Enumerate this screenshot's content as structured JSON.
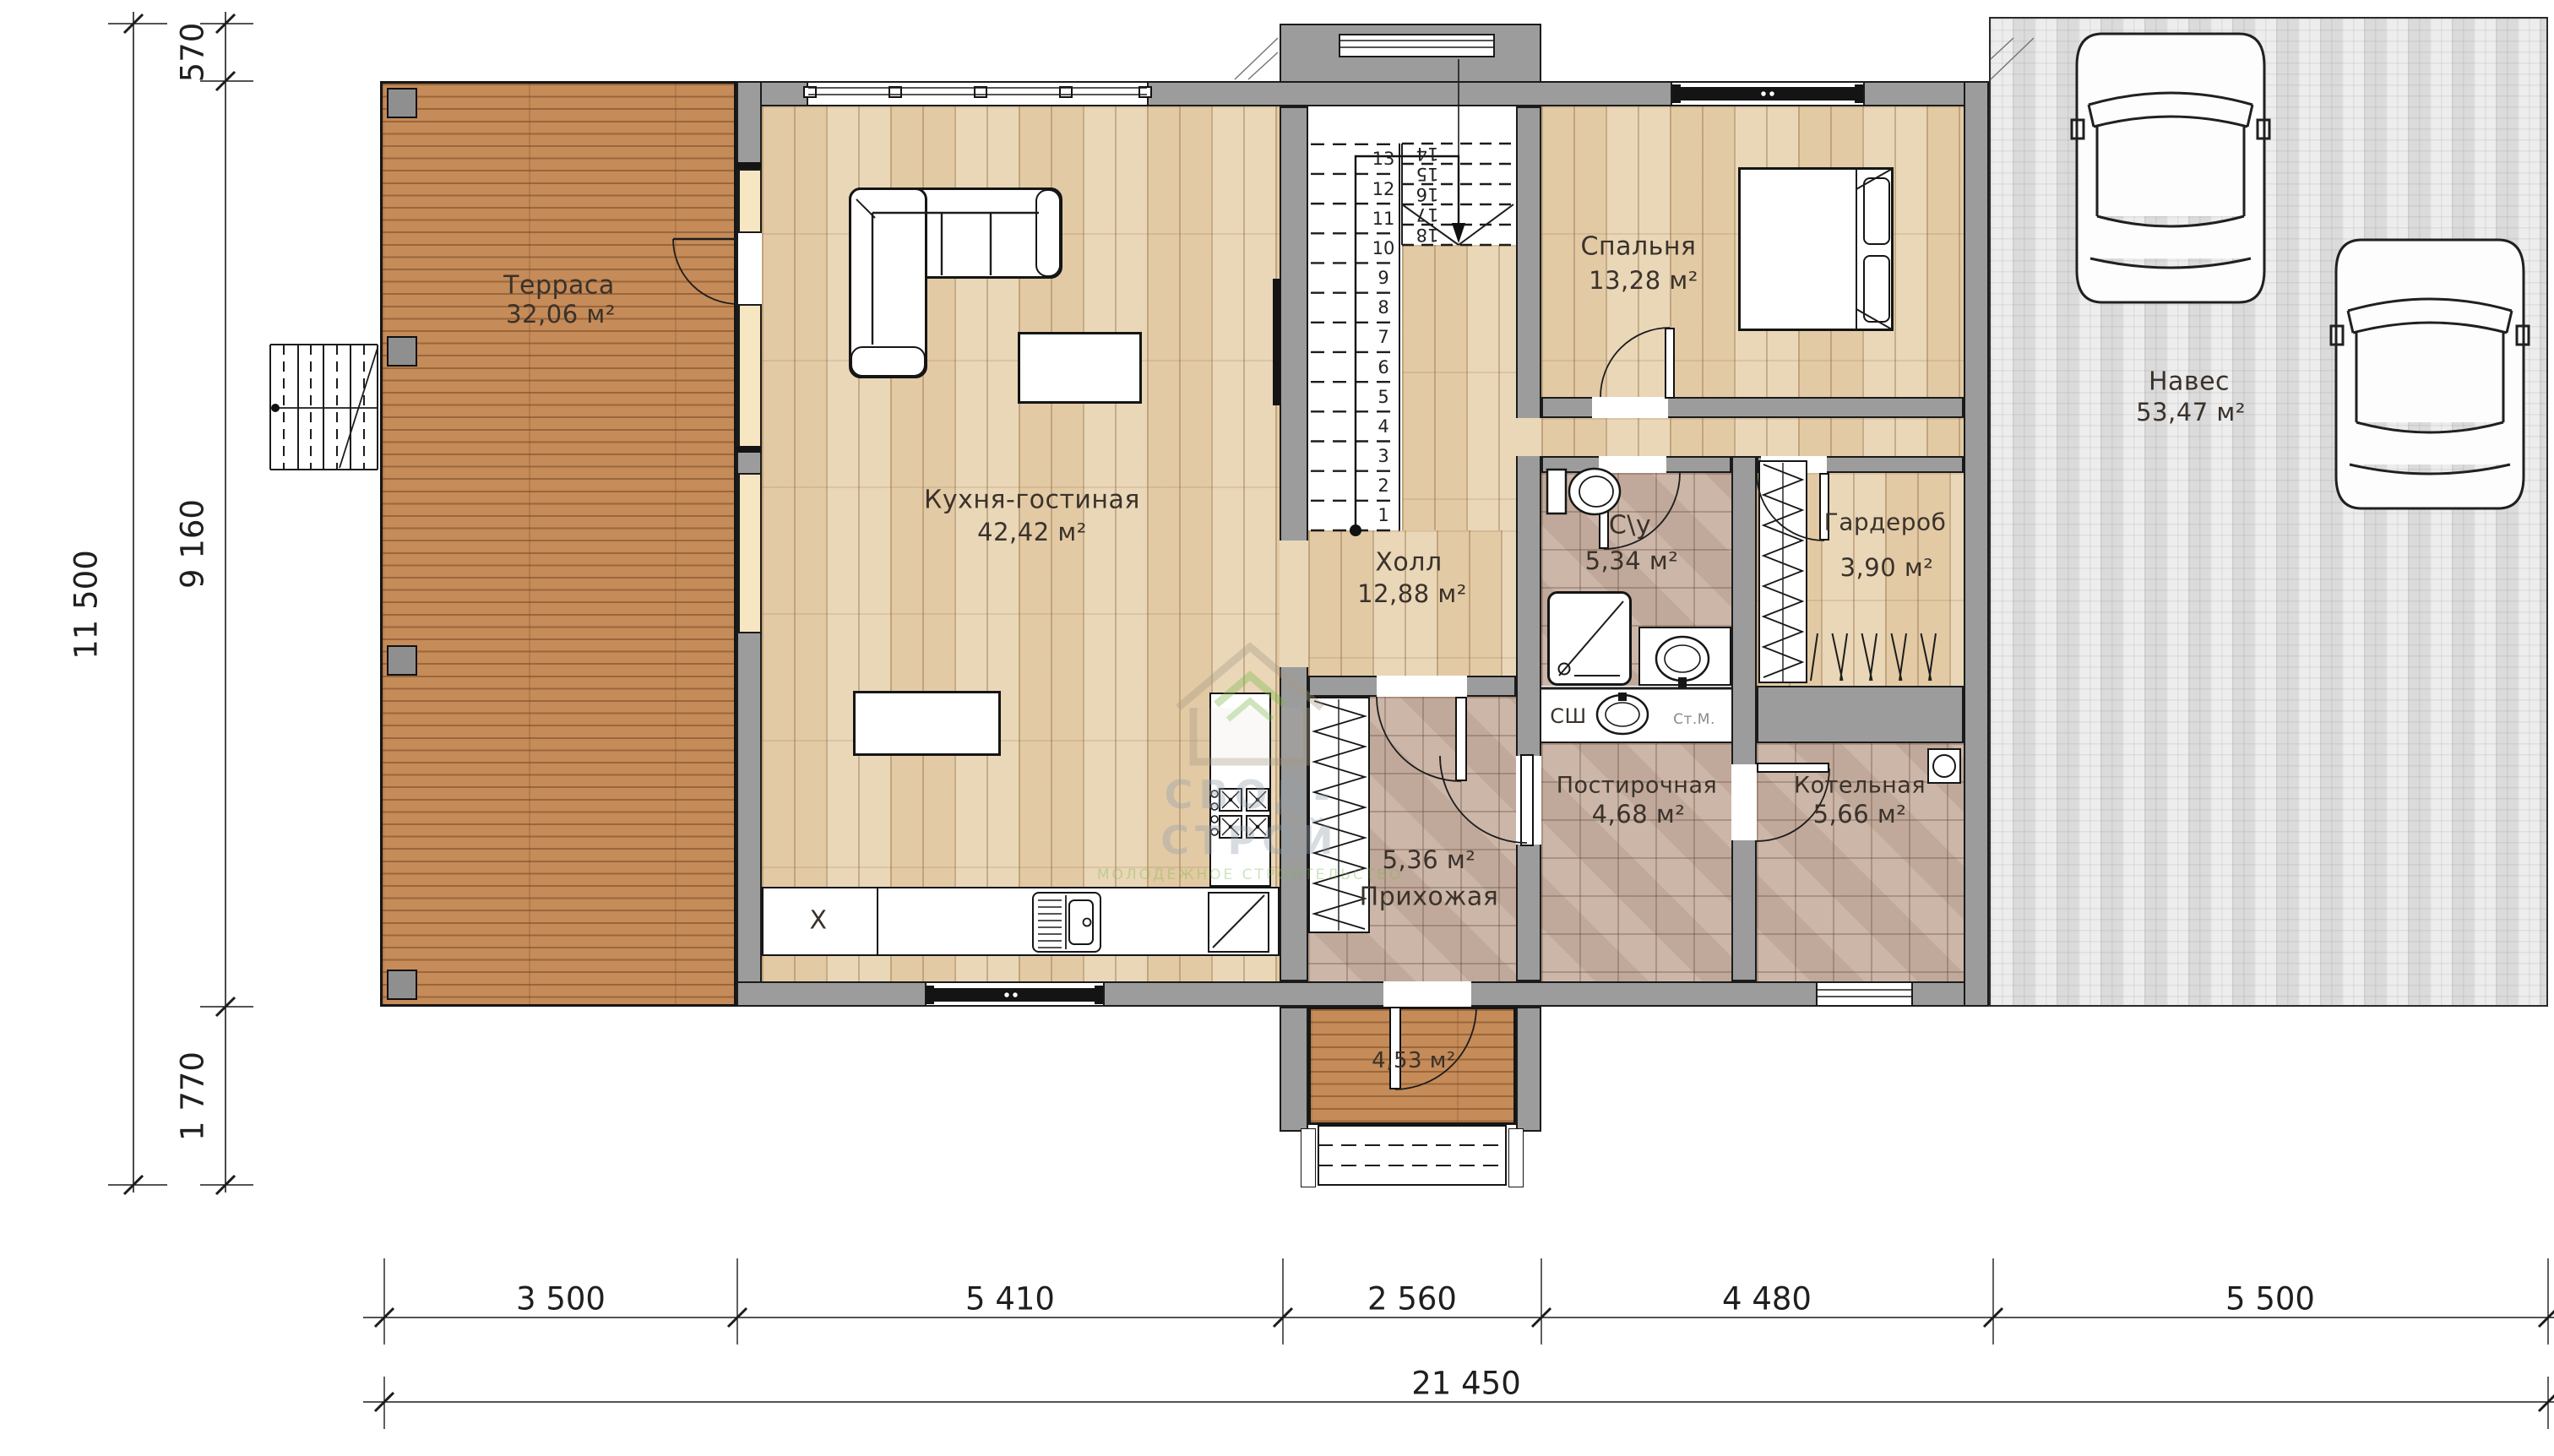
{
  "title": "Поэтажный план — 1 этаж",
  "colors": {
    "deck": "#c58b58",
    "parquet": "#e9d7b8",
    "tile": "#c8b1a2",
    "wall": "#9c9c9c",
    "paving": "#dbdbdb",
    "window_frame": "#f6e7c2",
    "line": "#1b1b1b",
    "watermark_green": "#7ab648",
    "watermark_gray": "#93a0ad"
  },
  "rooms": [
    {
      "id": "terrace",
      "name": "Терраса",
      "area": "32,06 м²"
    },
    {
      "id": "kitchen",
      "name": "Кухня-гостиная",
      "area": "42,42 м²"
    },
    {
      "id": "hall",
      "name": "Холл",
      "area": "12,88 м²"
    },
    {
      "id": "bedroom",
      "name": "Спальня",
      "area": "13,28 м²"
    },
    {
      "id": "bathroom",
      "name": "С\\у",
      "area": "5,34 м²"
    },
    {
      "id": "wardrobe",
      "name": "Гардероб",
      "area": "3,90 м²"
    },
    {
      "id": "laundry",
      "name": "Постирочная",
      "area": "4,68 м²"
    },
    {
      "id": "boiler_room",
      "name": "Котельная",
      "area": "5,66 м²"
    },
    {
      "id": "entryway",
      "name": "Прихожая",
      "area": "5,36 м²"
    },
    {
      "id": "canopy",
      "name": "Навес",
      "area": "53,47 м²"
    },
    {
      "id": "porch",
      "name": "",
      "area": "4,53 м²"
    }
  ],
  "appliance_labels": {
    "hob": "X",
    "dryer": "СШ",
    "washer": "Ст.М."
  },
  "stairs": {
    "steps": [
      "1",
      "2",
      "3",
      "4",
      "5",
      "6",
      "7",
      "8",
      "9",
      "10",
      "11",
      "12",
      "13",
      "14",
      "15",
      "16",
      "17",
      "18"
    ]
  },
  "dimensions": {
    "left_total": "11 500",
    "left_segments": [
      "570",
      "9 160",
      "1 770"
    ],
    "bottom_segments": [
      "3 500",
      "5 410",
      "2 560",
      "4 480",
      "5 500"
    ],
    "bottom_total": "21 450"
  },
  "watermark": {
    "line1": "СВОД-СТРОЙ",
    "line2": "МОЛОДЕЖНОЕ СТРОИТЕЛЬСТВО"
  }
}
